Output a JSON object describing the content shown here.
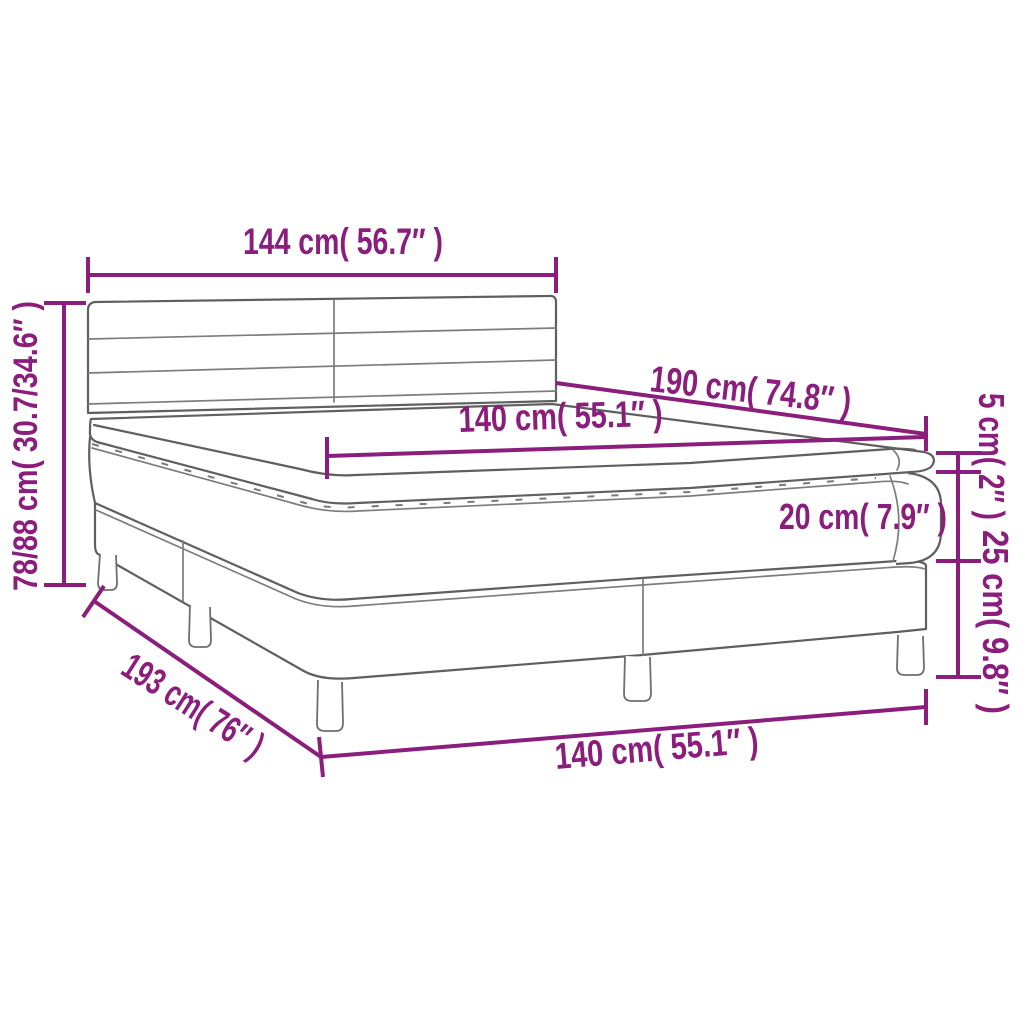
{
  "diagram": {
    "type": "product-dimension-diagram",
    "subject": "box spring bed with headboard, mattress and topper",
    "colors": {
      "dimension_lines": "#8B1E7D",
      "drawing_outline": "#5f5f5f",
      "background": "#ffffff"
    },
    "dimensions": {
      "headboard_width": {
        "label": "144 cm( 56.7″ )",
        "cm": "144",
        "inches": "56.7"
      },
      "total_height": {
        "label": "78/88 cm( 30.7/34.6″ )",
        "cm": "78/88",
        "inches": "30.7/34.6"
      },
      "bed_length": {
        "label": "190 cm( 74.8″ )",
        "cm": "190",
        "inches": "74.8"
      },
      "mattress_width": {
        "label": "140 cm( 55.1″ )",
        "cm": "140",
        "inches": "55.1"
      },
      "topper_height": {
        "label": "5 cm( 2″ )",
        "cm": "5",
        "inches": "2"
      },
      "mattress_height": {
        "label": "20 cm( 7.9″ )",
        "cm": "20",
        "inches": "7.9"
      },
      "base_height": {
        "label": "25 cm( 9.8″ )",
        "cm": "25",
        "inches": "9.8"
      },
      "total_length": {
        "label": "193 cm( 76″ )",
        "cm": "193",
        "inches": "76"
      },
      "base_width": {
        "label": "140 cm( 55.1″ )",
        "cm": "140",
        "inches": "55.1"
      }
    }
  }
}
